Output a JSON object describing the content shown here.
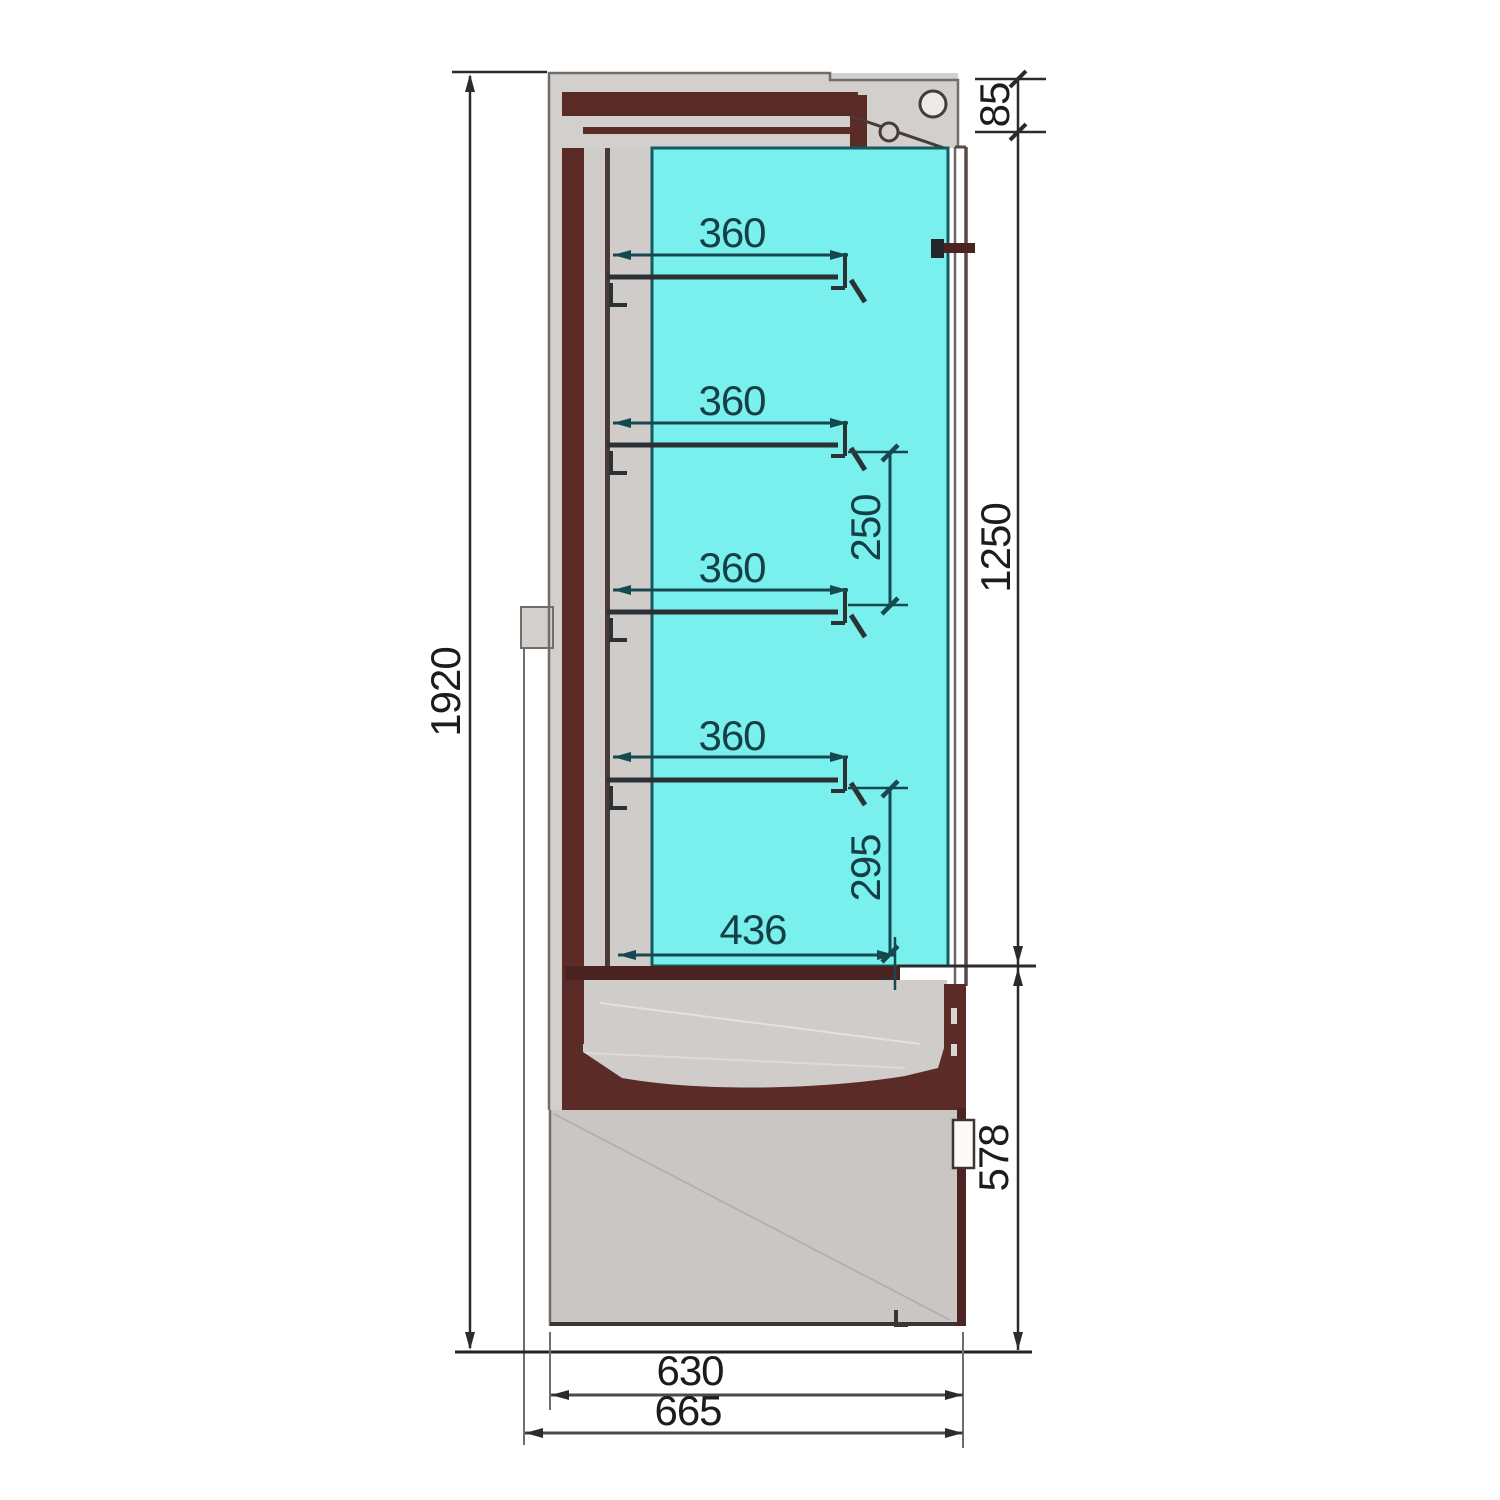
{
  "drawing": {
    "description": "side cross-section of glass-door multideck display cabinet",
    "dimensions": {
      "overall_height": "1920",
      "canopy_height": "85",
      "opening_height": "1250",
      "base_height": "578",
      "shelf_depths": [
        "360",
        "360",
        "360",
        "360"
      ],
      "shelf_spacing": "250",
      "bottom_shelf_spacing": "295",
      "base_shelf_depth": "436",
      "body_depth": "630",
      "overall_depth": "665"
    },
    "colors": {
      "interior_cyan": "#79efee",
      "interior_border": "#145a60",
      "insulation_maroon": "#5b2b27",
      "casing_gray": "#d2cfcc",
      "base_gray": "#c9c6c3",
      "outer_dimension_line": "#2b2b2b",
      "inner_dimension_line": "#16494f",
      "background": "#ffffff"
    }
  }
}
